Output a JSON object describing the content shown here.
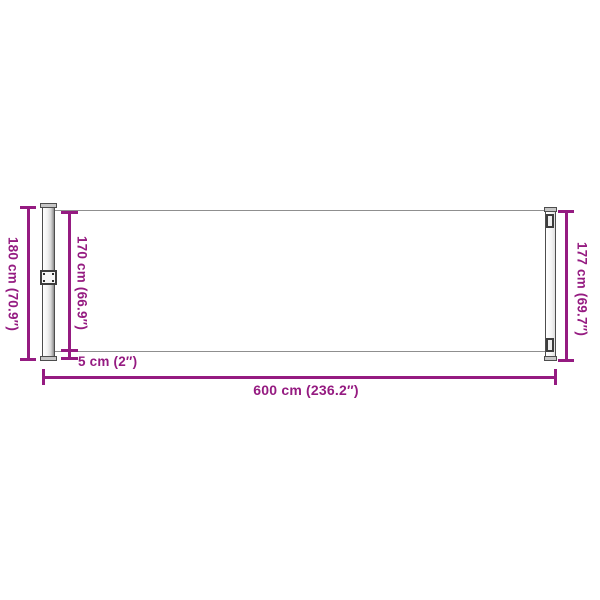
{
  "diagram": {
    "subject": "retractable side awning dimension drawing",
    "labels": {
      "post_height": "180 cm (70.9″)",
      "fabric_height": "170 cm (66.9″)",
      "pull_bar_height": "177 cm (69.7″)",
      "bottom_gap": "5 cm (2″)",
      "extension_length": "600 cm (236.2″)"
    },
    "colors": {
      "dimension_accent": "#951B81",
      "hardware_outline": "#4D4D4D",
      "hardware_fill": "#E8E8E8",
      "background": "#FFFFFF"
    }
  }
}
